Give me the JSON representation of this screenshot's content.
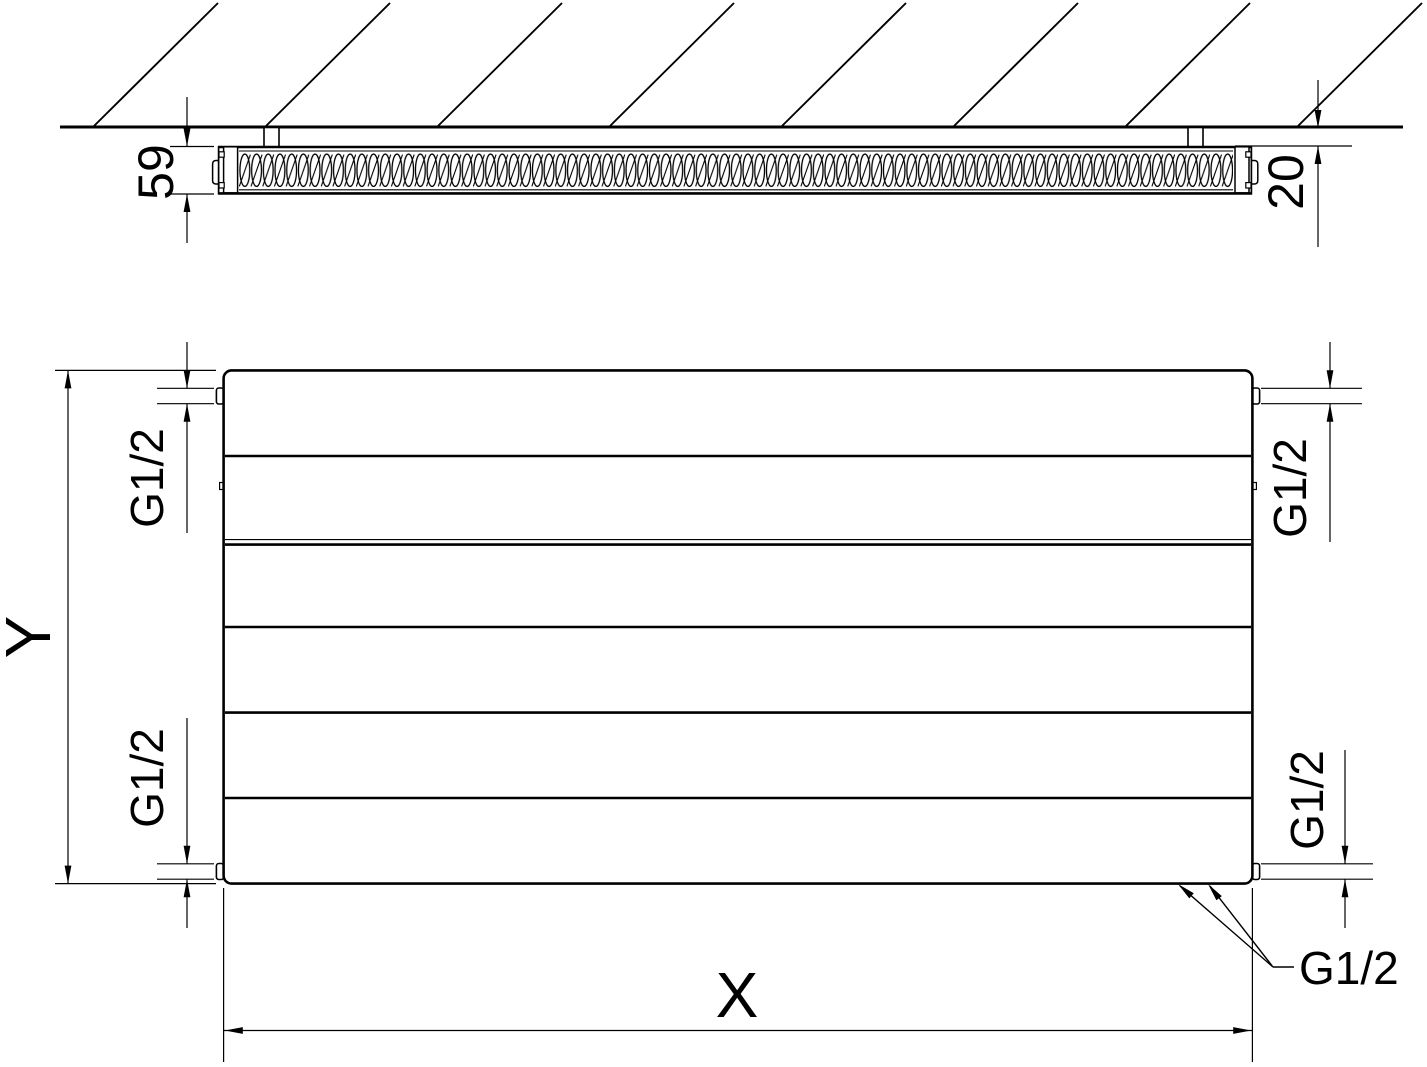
{
  "drawing": {
    "background": "#ffffff",
    "line_color": "#000000",
    "side_section": {
      "description": "radiator cross-section at hatched wall",
      "depth": "59",
      "wall_clearance": "20"
    },
    "front_view": {
      "height": "Y",
      "width": "X",
      "connection_top_left": "G1/2",
      "connection_top_right": "G1/2",
      "connection_bottom_left": "G1/2",
      "connection_bottom_right": "G1/2",
      "connection_leader": "G1/2"
    }
  }
}
